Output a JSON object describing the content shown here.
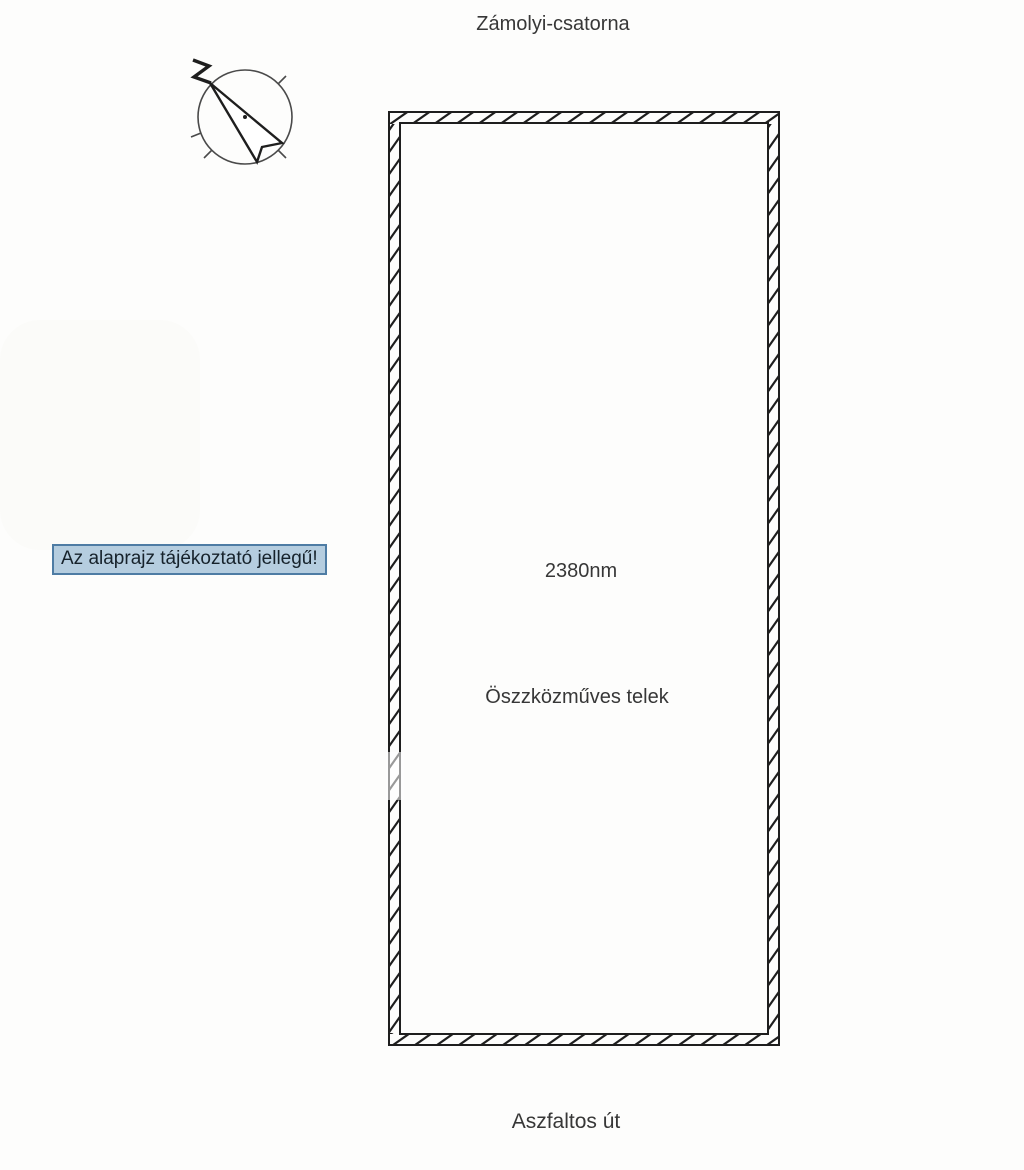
{
  "labels": {
    "canal": "Zámolyi-csatorna",
    "road": "Aszfaltos út",
    "area": "2380nm",
    "plot_type": "Öszzközműves telek",
    "disclaimer": "Az alaprajz tájékoztató jellegű!"
  },
  "icons": {
    "compass": "north-arrow-compass"
  },
  "colors": {
    "page_bg": "#fdfdfc",
    "line": "#1e1e1e",
    "text": "#373737",
    "note_bg": "#b5cddf",
    "note_border": "#4e7ca4",
    "note_text": "#16222b"
  }
}
